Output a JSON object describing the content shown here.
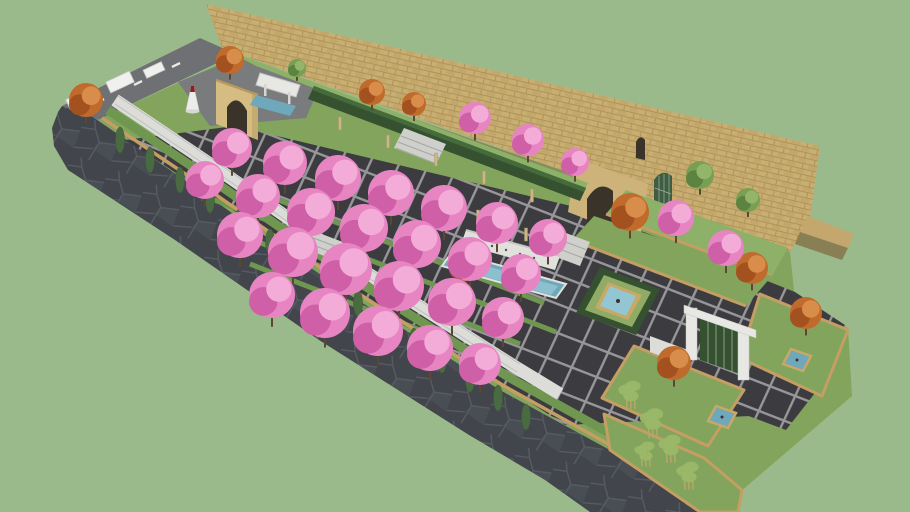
{
  "meta": {
    "description": "Aerial 3D model render of a long walled garden plaza: sandstone perimeter wall, cherry-blossom orchard over dark tile paving, cascade pool, square hedge fountain, trellis gate, terraced lawns, bamboo garden, flagstone and asphalt perimeter roads",
    "view": "isometric aerial"
  },
  "colors": {
    "background": "#9bba8c",
    "asphalt": "#6f7073",
    "road_line": "#e9e9e7",
    "flagstone": "#42464c",
    "flagstone_crack": "#575c62",
    "flagstone_tone": "#494e55",
    "entry_pad": "#7a7b7d",
    "curb": "#c49e63",
    "grass_base": "#83a45c",
    "grass_light": "#8db168",
    "grass_dark": "#6f9750",
    "wall_brick": "#c9ae72",
    "wall_brick_line": "#ab9058",
    "wall_brick_dark": "#bda164",
    "wall_wing": "#c3a76c",
    "wall_shadow": "#86744a",
    "porch": "#cdb379",
    "porch_trim": "#b89a5e",
    "arch_dark": "#3a332a",
    "lattice": "#3f5d45",
    "lattice_line": "#9fb49a",
    "stone_white": "#dcdcd8",
    "stone_line": "#bfbfbb",
    "steps": "#cfcfcb",
    "step_edge": "#a6a6a2",
    "tile": "#3c3c40",
    "grout": "#97979a",
    "hedge": "#35512f",
    "hedge_top": "#456b3c",
    "pool_wall": "#e0e1dc",
    "water": "#6fa8bb",
    "water_light": "#93c5d3",
    "fountain_grass": "#90ab66",
    "tan_frame": "#c8a865",
    "pergola_white": "#e7e8e3",
    "bench_white": "#f0f0ee",
    "bench_line": "#c6c6c2",
    "cone_white": "#ececea",
    "cone_red": "#8e1f1d",
    "trunk": "#5c4733",
    "post": "#cbb68a",
    "cypress": "#4a6a42",
    "cypress_edge": "#3d5a37",
    "bamboo_leaf": "#9ab868",
    "bamboo_trunk": "#b5a86a",
    "trees": {
      "cherry": {
        "base": "#e785c3",
        "light": "#f3abd7",
        "dark": "#cf5fa6"
      },
      "autumn": {
        "base": "#c06a2c",
        "light": "#d98d4a",
        "dark": "#a3511f"
      },
      "green": {
        "base": "#79a052",
        "light": "#92b56a",
        "dark": "#5d8340"
      }
    }
  },
  "scene": {
    "trees": {
      "cherry": [
        [
          232,
          148,
          20
        ],
        [
          285,
          163,
          22
        ],
        [
          338,
          178,
          23
        ],
        [
          391,
          193,
          23
        ],
        [
          444,
          208,
          23
        ],
        [
          497,
          223,
          21
        ],
        [
          548,
          238,
          19
        ],
        [
          205,
          180,
          19
        ],
        [
          258,
          196,
          22
        ],
        [
          311,
          212,
          24
        ],
        [
          364,
          228,
          24
        ],
        [
          417,
          244,
          24
        ],
        [
          470,
          259,
          22
        ],
        [
          521,
          274,
          20
        ],
        [
          240,
          235,
          23
        ],
        [
          293,
          252,
          25
        ],
        [
          346,
          269,
          26
        ],
        [
          399,
          286,
          25
        ],
        [
          452,
          302,
          24
        ],
        [
          503,
          318,
          21
        ],
        [
          272,
          295,
          23
        ],
        [
          325,
          313,
          25
        ],
        [
          378,
          331,
          25
        ],
        [
          430,
          348,
          23
        ],
        [
          480,
          364,
          21
        ],
        [
          475,
          118,
          16
        ],
        [
          528,
          140,
          16
        ],
        [
          575,
          162,
          14
        ],
        [
          676,
          218,
          18
        ],
        [
          726,
          248,
          18
        ]
      ],
      "autumn": [
        [
          86,
          100,
          17
        ],
        [
          230,
          60,
          14
        ],
        [
          372,
          92,
          13
        ],
        [
          414,
          104,
          12
        ],
        [
          466,
          264,
          17
        ],
        [
          630,
          212,
          19
        ],
        [
          752,
          268,
          16
        ],
        [
          806,
          313,
          16
        ],
        [
          674,
          363,
          17
        ]
      ],
      "green": [
        [
          297,
          68,
          9
        ],
        [
          700,
          175,
          14
        ],
        [
          748,
          200,
          12
        ]
      ]
    },
    "cypresses": [
      [
        120,
        140
      ],
      [
        150,
        160
      ],
      [
        180,
        180
      ],
      [
        210,
        200
      ],
      [
        240,
        221
      ],
      [
        270,
        242
      ],
      [
        300,
        263
      ],
      [
        330,
        284
      ],
      [
        358,
        303
      ],
      [
        386,
        322
      ],
      [
        414,
        341
      ],
      [
        442,
        360
      ],
      [
        470,
        379
      ],
      [
        498,
        398
      ],
      [
        526,
        417
      ]
    ],
    "bamboo": [
      [
        630,
        392,
        14
      ],
      [
        652,
        420,
        15
      ],
      [
        670,
        446,
        14
      ],
      [
        688,
        473,
        14
      ],
      [
        645,
        452,
        12
      ]
    ],
    "benches": [
      [
        78,
        100,
        22,
        11
      ],
      [
        120,
        82,
        26,
        12
      ],
      [
        154,
        70,
        20,
        9
      ]
    ],
    "road_dashes": [
      [
        100,
        101
      ],
      [
        138,
        83
      ],
      [
        176,
        65
      ]
    ],
    "pergola_posts": [
      [
        340,
        130
      ],
      [
        388,
        148
      ],
      [
        436,
        166
      ],
      [
        484,
        184
      ],
      [
        532,
        202
      ],
      [
        430,
        205
      ],
      [
        478,
        223
      ],
      [
        526,
        241
      ]
    ],
    "grass_strips": [
      [
        196,
        168,
        544,
        303
      ],
      [
        212,
        199,
        556,
        332
      ],
      [
        230,
        231,
        520,
        344
      ],
      [
        250,
        264,
        490,
        357
      ]
    ],
    "garden_pools": [
      [
        797,
        360
      ],
      [
        722,
        417
      ]
    ],
    "cascade_spouts": [
      [
        478,
        242
      ],
      [
        492,
        246
      ],
      [
        506,
        250
      ],
      [
        520,
        254
      ],
      [
        534,
        258
      ],
      [
        548,
        261
      ]
    ]
  }
}
